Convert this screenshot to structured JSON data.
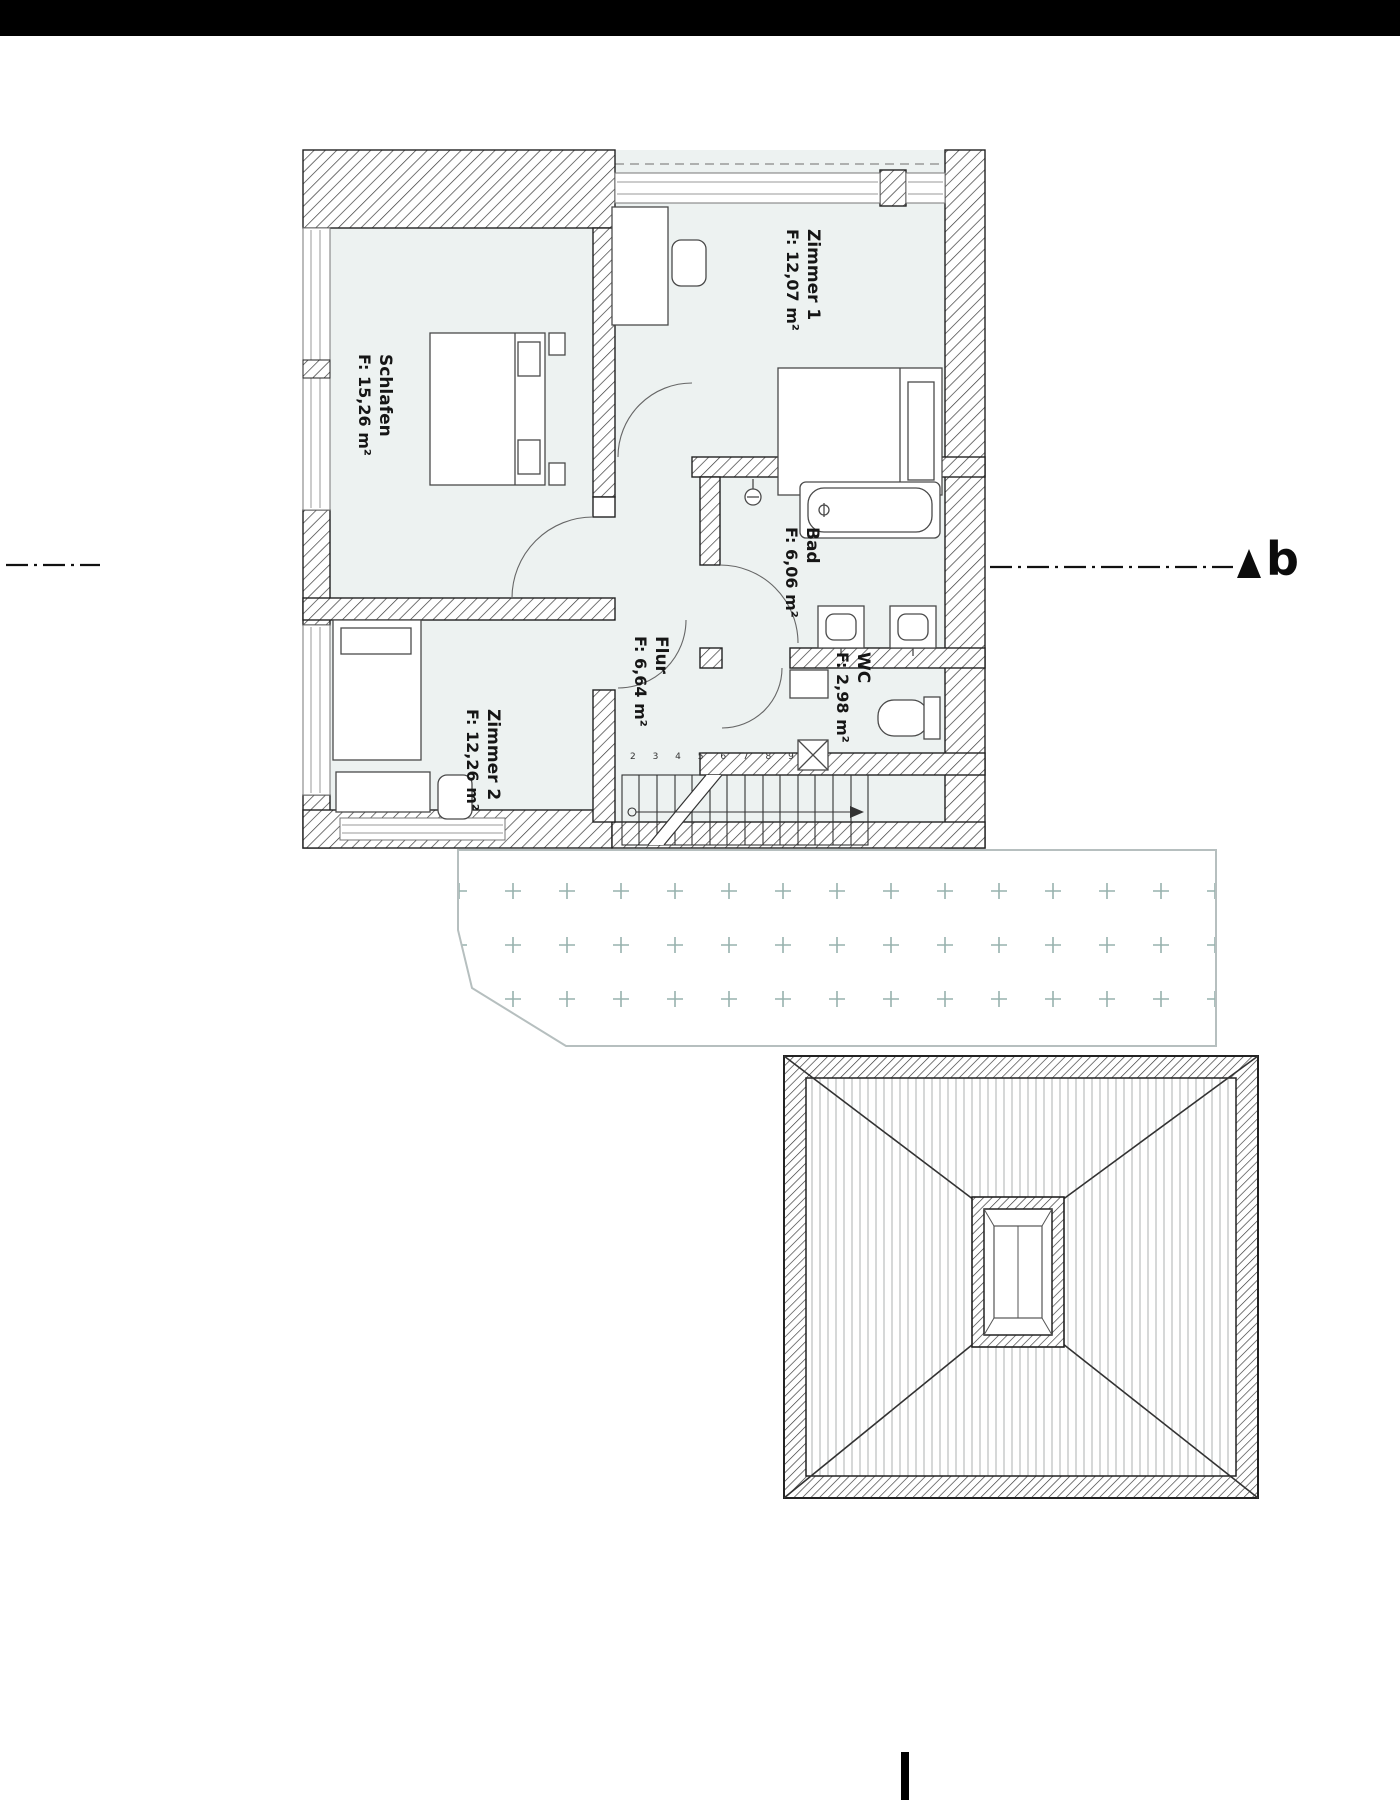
{
  "page": {
    "type": "architectural floor plan (Obergeschoss) with terrace and hip roof",
    "background": "#ffffff",
    "top_bar_color": "#000000"
  },
  "plan": {
    "rooms": {
      "schlafen": {
        "name": "Schlafen",
        "area": "F: 15,26 m²"
      },
      "zimmer1": {
        "name": "Zimmer 1",
        "area": "F: 12,07 m²"
      },
      "zimmer2": {
        "name": "Zimmer 2",
        "area": "F: 12,26 m²"
      },
      "bad": {
        "name": "Bad",
        "area": "F: 6,06 m²"
      },
      "flur": {
        "name": "Flur",
        "area": "F: 6,64 m²"
      },
      "wc": {
        "name": "WC",
        "area": "F: 2,98 m²"
      }
    },
    "stairs": {
      "step_numbers": "2 3 4 5 6 7 8 9"
    },
    "section_marker": {
      "label": "b"
    },
    "colors": {
      "room_fill": "#edf2f1",
      "terrace_cross": "#97b2ae",
      "line": "#222222"
    }
  }
}
